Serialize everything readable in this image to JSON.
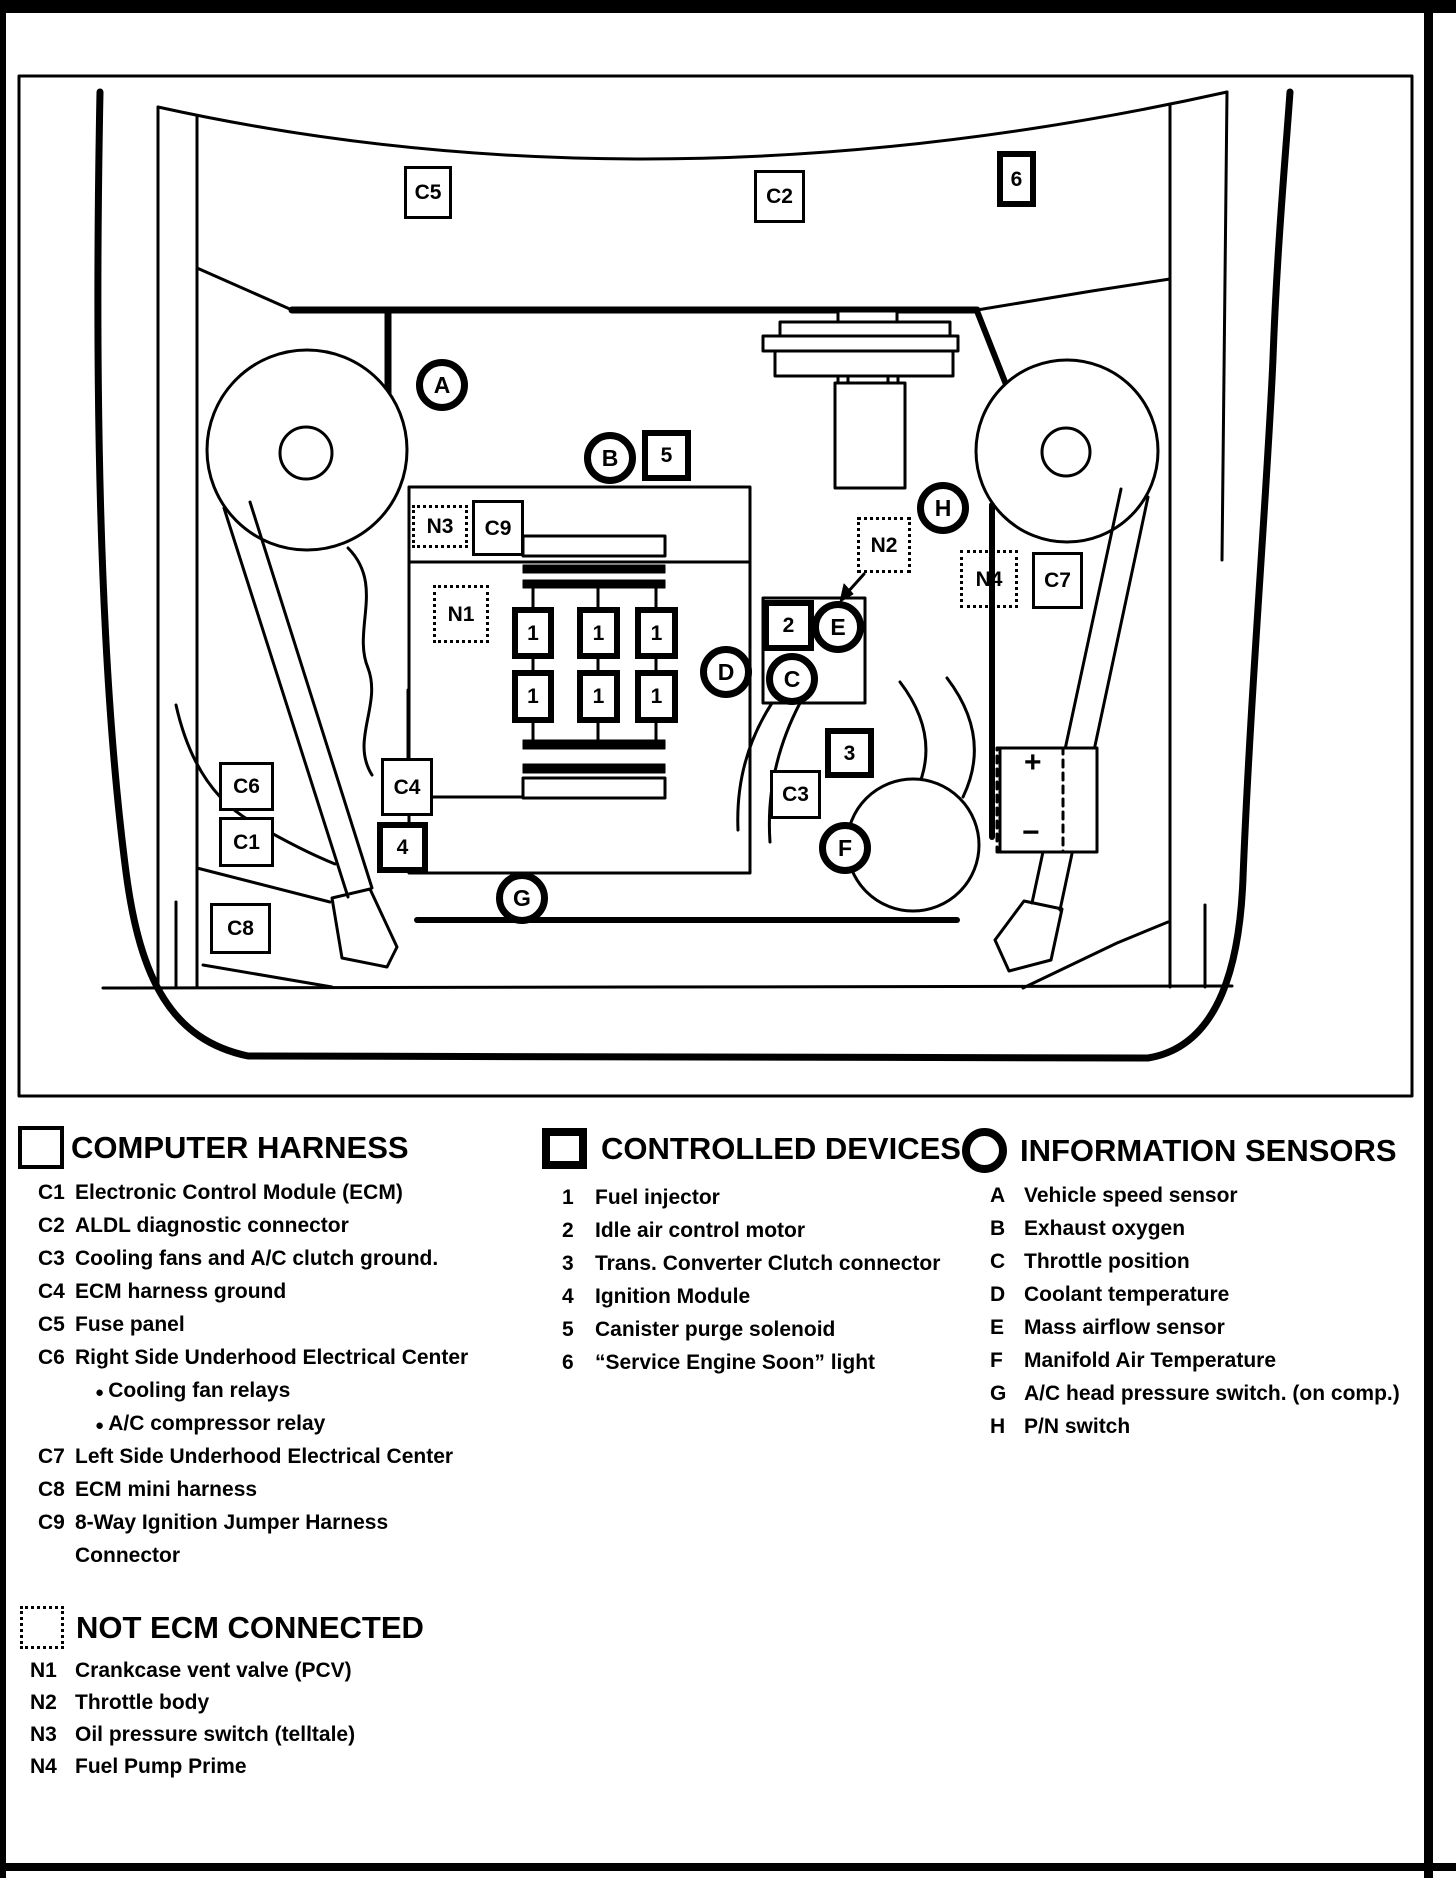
{
  "legend": {
    "computer_harness": {
      "title": "COMPUTER HARNESS",
      "rows": [
        {
          "code": "C1",
          "text": "Electronic Control Module (ECM)"
        },
        {
          "code": "C2",
          "text": "ALDL diagnostic connector"
        },
        {
          "code": "C3",
          "text": "Cooling fans and A/C clutch ground."
        },
        {
          "code": "C4",
          "text": "ECM harness ground"
        },
        {
          "code": "C5",
          "text": "Fuse panel"
        },
        {
          "code": "C6",
          "text": "Right Side Underhood Electrical  Center"
        },
        {
          "type": "bullet",
          "text": "Cooling fan relays"
        },
        {
          "type": "bullet",
          "text": "A/C compressor relay"
        },
        {
          "code": "C7",
          "text": "Left Side Underhood Electrical Center"
        },
        {
          "code": "C8",
          "text": "ECM mini harness"
        },
        {
          "code": "C9",
          "text": "8-Way Ignition Jumper Harness"
        },
        {
          "type": "cont",
          "text": "Connector"
        }
      ]
    },
    "controlled_devices": {
      "title": "CONTROLLED DEVICES",
      "rows": [
        {
          "code": "1",
          "text": "Fuel injector"
        },
        {
          "code": "2",
          "text": "Idle air control motor"
        },
        {
          "code": "3",
          "text": "Trans. Converter Clutch connector"
        },
        {
          "code": "4",
          "text": "Ignition Module"
        },
        {
          "code": "5",
          "text": "Canister purge solenoid"
        },
        {
          "code": "6",
          "text": "“Service Engine Soon” light"
        }
      ]
    },
    "information_sensors": {
      "title": "INFORMATION SENSORS",
      "rows": [
        {
          "code": "A",
          "text": "Vehicle speed sensor"
        },
        {
          "code": "B",
          "text": "Exhaust oxygen"
        },
        {
          "code": "C",
          "text": "Throttle position"
        },
        {
          "code": "D",
          "text": "Coolant temperature"
        },
        {
          "code": "E",
          "text": "Mass airflow sensor"
        },
        {
          "code": "F",
          "text": "Manifold Air Temperature"
        },
        {
          "code": "G",
          "text": "A/C head pressure switch. (on comp.)"
        },
        {
          "code": "H",
          "text": "P/N switch"
        }
      ]
    },
    "not_ecm_connected": {
      "title": "NOT ECM CONNECTED",
      "rows": [
        {
          "code": "N1",
          "text": "Crankcase vent valve (PCV)"
        },
        {
          "code": "N2",
          "text": "Throttle body"
        },
        {
          "code": "N3",
          "text": "Oil pressure switch (telltale)"
        },
        {
          "code": "N4",
          "text": "Fuel Pump Prime"
        }
      ]
    }
  },
  "diagram": {
    "harness_boxes": [
      {
        "label": "C5",
        "x": 404,
        "y": 166,
        "w": 48,
        "h": 53
      },
      {
        "label": "C2",
        "x": 754,
        "y": 170,
        "w": 51,
        "h": 53
      },
      {
        "label": "C9",
        "x": 472,
        "y": 500,
        "w": 52,
        "h": 56
      },
      {
        "label": "C7",
        "x": 1032,
        "y": 552,
        "w": 51,
        "h": 57
      },
      {
        "label": "C4",
        "x": 381,
        "y": 758,
        "w": 52,
        "h": 58
      },
      {
        "label": "C6",
        "x": 219,
        "y": 762,
        "w": 55,
        "h": 49
      },
      {
        "label": "C3",
        "x": 770,
        "y": 770,
        "w": 51,
        "h": 49
      },
      {
        "label": "C1",
        "x": 219,
        "y": 817,
        "w": 55,
        "h": 50
      },
      {
        "label": "C8",
        "x": 210,
        "y": 903,
        "w": 61,
        "h": 51
      }
    ],
    "device_boxes": [
      {
        "label": "6",
        "x": 997,
        "y": 151,
        "w": 39,
        "h": 56
      },
      {
        "label": "5",
        "x": 642,
        "y": 430,
        "w": 49,
        "h": 51
      },
      {
        "label": "2",
        "x": 763,
        "y": 600,
        "w": 51,
        "h": 51
      },
      {
        "label": "1",
        "x": 512,
        "y": 607,
        "w": 42,
        "h": 52
      },
      {
        "label": "1",
        "x": 577,
        "y": 607,
        "w": 43,
        "h": 52
      },
      {
        "label": "1",
        "x": 635,
        "y": 607,
        "w": 43,
        "h": 52
      },
      {
        "label": "1",
        "x": 512,
        "y": 670,
        "w": 42,
        "h": 53
      },
      {
        "label": "1",
        "x": 577,
        "y": 670,
        "w": 43,
        "h": 53
      },
      {
        "label": "1",
        "x": 635,
        "y": 670,
        "w": 43,
        "h": 53
      },
      {
        "label": "3",
        "x": 825,
        "y": 728,
        "w": 49,
        "h": 50
      },
      {
        "label": "4",
        "x": 377,
        "y": 822,
        "w": 51,
        "h": 51
      }
    ],
    "not_ecm_boxes": [
      {
        "label": "N3",
        "x": 412,
        "y": 505,
        "w": 56,
        "h": 43
      },
      {
        "label": "N2",
        "x": 857,
        "y": 517,
        "w": 54,
        "h": 56
      },
      {
        "label": "N4",
        "x": 960,
        "y": 550,
        "w": 58,
        "h": 58
      },
      {
        "label": "N1",
        "x": 433,
        "y": 585,
        "w": 56,
        "h": 58
      }
    ],
    "sensor_circles": [
      {
        "label": "A",
        "cx": 442,
        "cy": 385
      },
      {
        "label": "B",
        "cx": 610,
        "cy": 458
      },
      {
        "label": "H",
        "cx": 943,
        "cy": 508
      },
      {
        "label": "E",
        "cx": 838,
        "cy": 627
      },
      {
        "label": "D",
        "cx": 726,
        "cy": 672
      },
      {
        "label": "C",
        "cx": 792,
        "cy": 679
      },
      {
        "label": "F",
        "cx": 845,
        "cy": 848
      },
      {
        "label": "G",
        "cx": 522,
        "cy": 898
      }
    ],
    "battery": {
      "plus": "+",
      "minus": "−"
    }
  }
}
